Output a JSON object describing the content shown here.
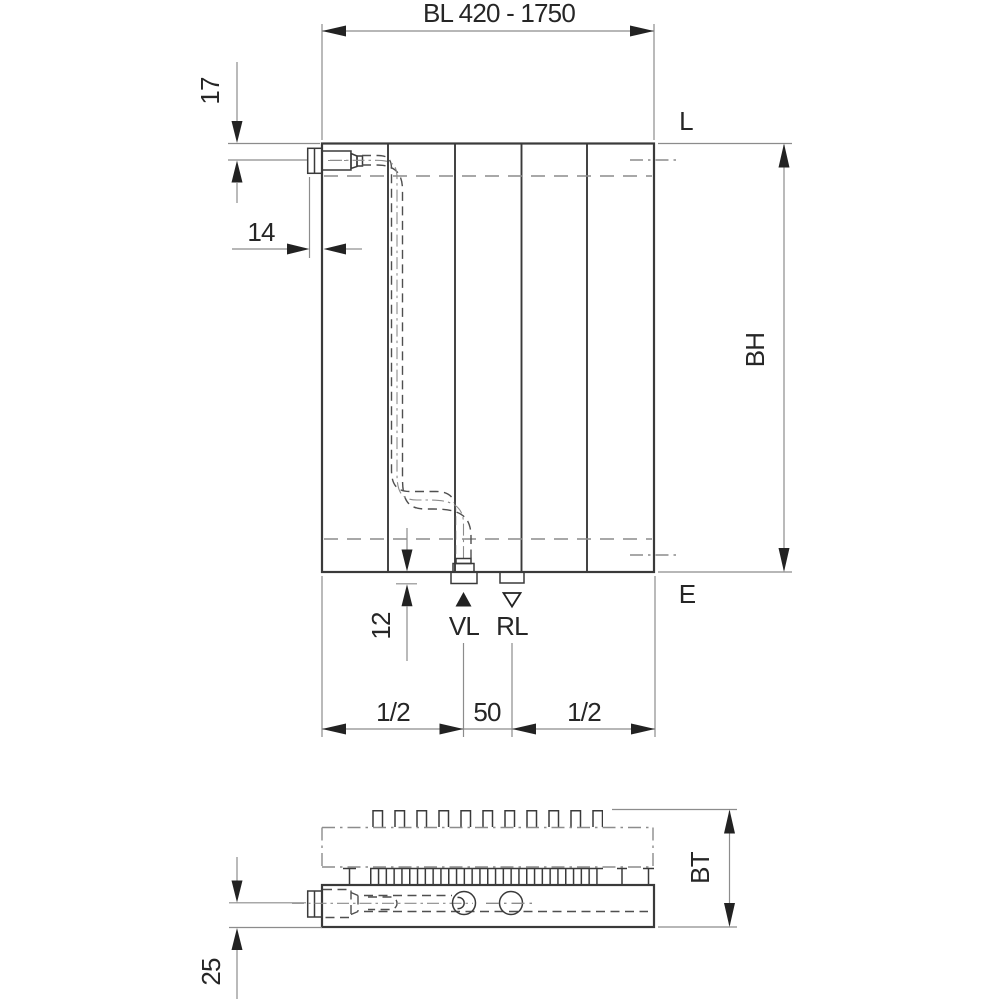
{
  "front_view": {
    "dim_length": "BL 420 - 1750",
    "dim_top_offset": "17",
    "dim_left_offset": "14",
    "dim_bottom_offset": "12",
    "dim_height": "BH",
    "dim_half_left": "1/2",
    "dim_spacing": "50",
    "dim_half_right": "1/2",
    "label_air_vent": "L",
    "label_drain": "E",
    "label_supply": "VL",
    "label_return": "RL"
  },
  "bottom_view": {
    "dim_depth": "BT",
    "dim_connection_offset": "25"
  },
  "colors": {
    "line": "#3a3a3a",
    "dim_line": "#8c8c8c",
    "arrow": "#222222",
    "pipe": "#4f4f4f",
    "text": "#262626",
    "background": "#ffffff"
  }
}
